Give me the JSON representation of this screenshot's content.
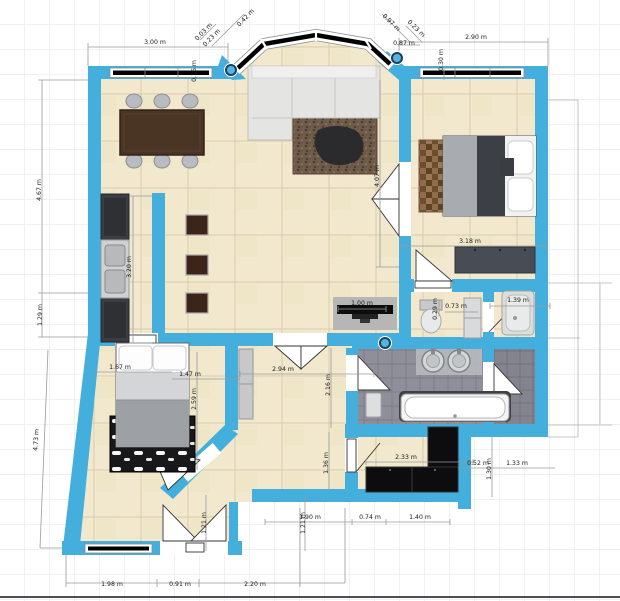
{
  "editor": {
    "canvas_kind": "floor-plan-2d-view",
    "unit_suffix": "m"
  },
  "colors": {
    "wall": "#44aedc",
    "wall_node_fill": "#57b4e0",
    "wall_node_ring": "#16425f",
    "floor_tile": "#f1e8cd",
    "floor_grout": "#d9cda9",
    "bath_tile": "#8f8f9a",
    "bath_tile_dark": "#84848f",
    "window_glass": "#000000",
    "door_leaf": "#ffffff",
    "dimension_line": "#9a9a9a",
    "dimension_text": "#1a1a1a",
    "grid_line": "#edf1f4",
    "background": "#ffffff"
  },
  "object_icons": [
    "dining-table",
    "dining-chair",
    "kitchen-cabinet",
    "kitchen-sink",
    "bar-stool",
    "corner-sofa",
    "area-rug",
    "coffee-table",
    "tv-bench",
    "double-bed",
    "bedside-rug",
    "dresser",
    "toilet",
    "bathroom-cabinet",
    "shower-tray",
    "double-vanity-sinks",
    "bathtub",
    "hall-wardrobe",
    "closet-wardrobe",
    "patterned-rug"
  ],
  "wall_nodes": [
    {
      "x": 231,
      "y": 70
    },
    {
      "x": 397,
      "y": 58
    },
    {
      "x": 385,
      "y": 343
    }
  ],
  "dimension_labels": [
    {
      "t": "3.00 m",
      "x": 155,
      "y": 44,
      "r": 0
    },
    {
      "t": "0.03 m",
      "x": 205,
      "y": 33,
      "r": -46
    },
    {
      "t": "0.42 m",
      "x": 247,
      "y": 19,
      "r": -46
    },
    {
      "t": "0.23 m",
      "x": 213,
      "y": 39,
      "r": -46
    },
    {
      "t": "0.16 m",
      "x": 196,
      "y": 71,
      "r": -90
    },
    {
      "t": "0.97 m",
      "x": 390,
      "y": 24,
      "r": 44
    },
    {
      "t": "0.23 m",
      "x": 415,
      "y": 30,
      "r": 44
    },
    {
      "t": "0.87 m",
      "x": 404,
      "y": 45,
      "r": 0
    },
    {
      "t": "0.30 m",
      "x": 443,
      "y": 60,
      "r": -90
    },
    {
      "t": "2.90 m",
      "x": 476,
      "y": 39,
      "r": 0
    },
    {
      "t": "4.67 m",
      "x": 41,
      "y": 190,
      "r": -90
    },
    {
      "t": "1.29 m",
      "x": 42,
      "y": 315,
      "r": -90
    },
    {
      "t": "4.73 m",
      "x": 38,
      "y": 440,
      "r": -87
    },
    {
      "t": "3.20 m",
      "x": 131,
      "y": 267,
      "r": -90
    },
    {
      "t": "4.07 m",
      "x": 379,
      "y": 176,
      "r": -90
    },
    {
      "t": "1.00 m",
      "x": 362,
      "y": 305,
      "r": 0
    },
    {
      "t": "0.29 m",
      "x": 437,
      "y": 309,
      "r": -90
    },
    {
      "t": "0.73 m",
      "x": 456,
      "y": 308,
      "r": 0
    },
    {
      "t": "1.39 m",
      "x": 518,
      "y": 302,
      "r": 0
    },
    {
      "t": "3.18 m",
      "x": 470,
      "y": 243,
      "r": 0
    },
    {
      "t": "1.67 m",
      "x": 120,
      "y": 369,
      "r": 0
    },
    {
      "t": "1.47 m",
      "x": 190,
      "y": 376,
      "r": 0
    },
    {
      "t": "2.59 m",
      "x": 196,
      "y": 399,
      "r": -90
    },
    {
      "t": "2.94 m",
      "x": 283,
      "y": 371,
      "r": 0
    },
    {
      "t": "2.16 m",
      "x": 330,
      "y": 385,
      "r": -90
    },
    {
      "t": "1.36 m",
      "x": 328,
      "y": 463,
      "r": -90
    },
    {
      "t": "2.33 m",
      "x": 406,
      "y": 459,
      "r": 0
    },
    {
      "t": "0.52 m",
      "x": 478,
      "y": 465,
      "r": 0
    },
    {
      "t": "1.30 m",
      "x": 491,
      "y": 469,
      "r": -90
    },
    {
      "t": "1.33 m",
      "x": 517,
      "y": 465,
      "r": 0
    },
    {
      "t": "1.21 m",
      "x": 206,
      "y": 523,
      "r": -90
    },
    {
      "t": "1.21 m",
      "x": 305,
      "y": 523,
      "r": -90
    },
    {
      "t": "1.90 m",
      "x": 310,
      "y": 519,
      "r": 0
    },
    {
      "t": "0.74 m",
      "x": 370,
      "y": 519,
      "r": 0
    },
    {
      "t": "1.40 m",
      "x": 420,
      "y": 519,
      "r": 0
    },
    {
      "t": "1.98 m",
      "x": 112,
      "y": 586,
      "r": 0
    },
    {
      "t": "0.91 m",
      "x": 180,
      "y": 586,
      "r": 0
    },
    {
      "t": "2.20 m",
      "x": 255,
      "y": 586,
      "r": 0
    }
  ]
}
